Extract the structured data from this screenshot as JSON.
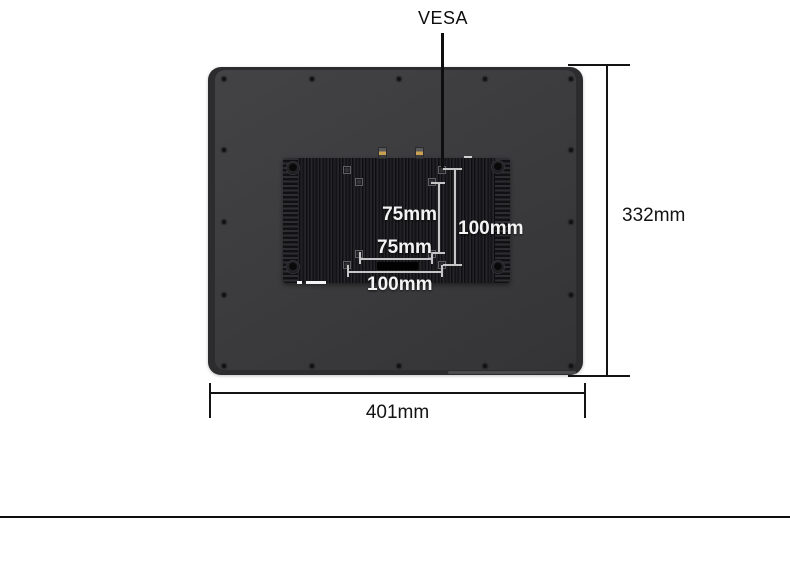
{
  "diagram": {
    "vesa_label": "VESA",
    "vesa_pattern": {
      "inner_vertical": "75mm",
      "inner_horizontal": "75mm",
      "outer_vertical": "100mm",
      "outer_horizontal": "100mm"
    },
    "overall": {
      "height": "332mm",
      "width": "401mm"
    },
    "colors": {
      "background": "#ffffff",
      "body": "#3c3c3e",
      "body_frame": "#2c2c2e",
      "heatsink": "#19191c",
      "antenna_gold": "#c9a051",
      "dim_line_dark": "#131313",
      "dim_line_light": "#c6c6c6",
      "label_light": "#f3f3f3"
    }
  }
}
